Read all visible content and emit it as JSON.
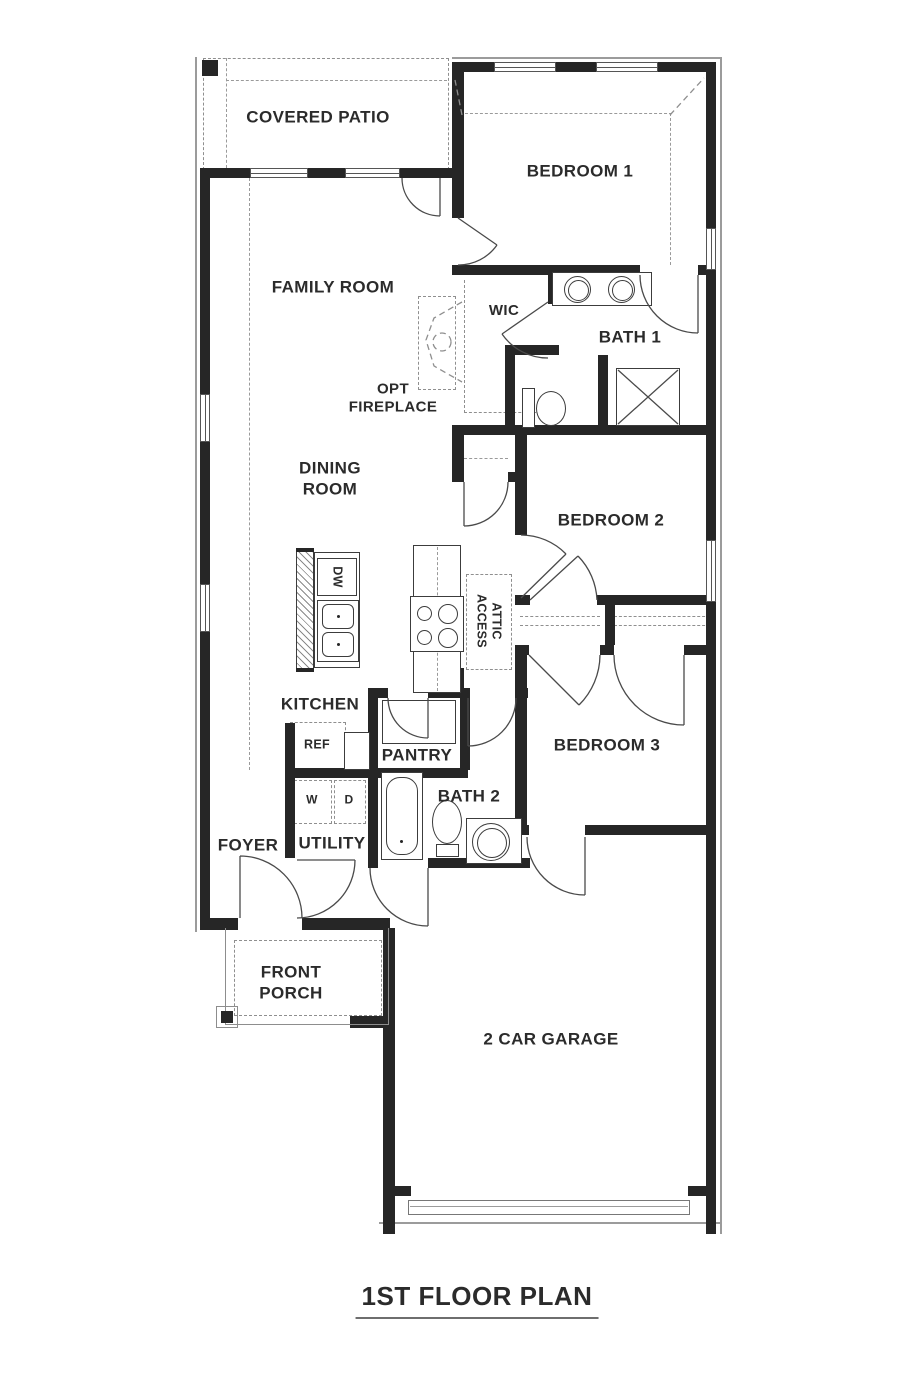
{
  "title": "1ST FLOOR PLAN",
  "rooms": {
    "covered_patio": {
      "label": "COVERED PATIO"
    },
    "bedroom_1": {
      "label": "BEDROOM 1"
    },
    "family_room": {
      "label": "FAMILY ROOM"
    },
    "wic": {
      "label": "WIC"
    },
    "bath_1": {
      "label": "BATH 1"
    },
    "dining_room": {
      "line1": "DINING",
      "line2": "ROOM"
    },
    "bedroom_2": {
      "label": "BEDROOM 2"
    },
    "kitchen": {
      "label": "KITCHEN"
    },
    "pantry": {
      "label": "PANTRY"
    },
    "bedroom_3": {
      "label": "BEDROOM 3"
    },
    "bath_2": {
      "label": "BATH 2"
    },
    "foyer": {
      "label": "FOYER"
    },
    "utility": {
      "label": "UTILITY"
    },
    "front_porch": {
      "line1": "FRONT",
      "line2": "PORCH"
    },
    "garage": {
      "label": "2 CAR GARAGE"
    }
  },
  "annotations": {
    "opt_fireplace": {
      "line1": "OPT",
      "line2": "FIREPLACE"
    },
    "attic_access": {
      "line1": "ATTIC",
      "line2": "ACCESS"
    }
  },
  "appliances": {
    "dishwasher": "DW",
    "refrigerator": "REF",
    "washer": "W",
    "dryer": "D"
  },
  "colors": {
    "wall": "#262626",
    "line": "#4a4a4a",
    "dashed": "#8f8f8f",
    "text": "#2b2b2b",
    "background": "#ffffff"
  }
}
